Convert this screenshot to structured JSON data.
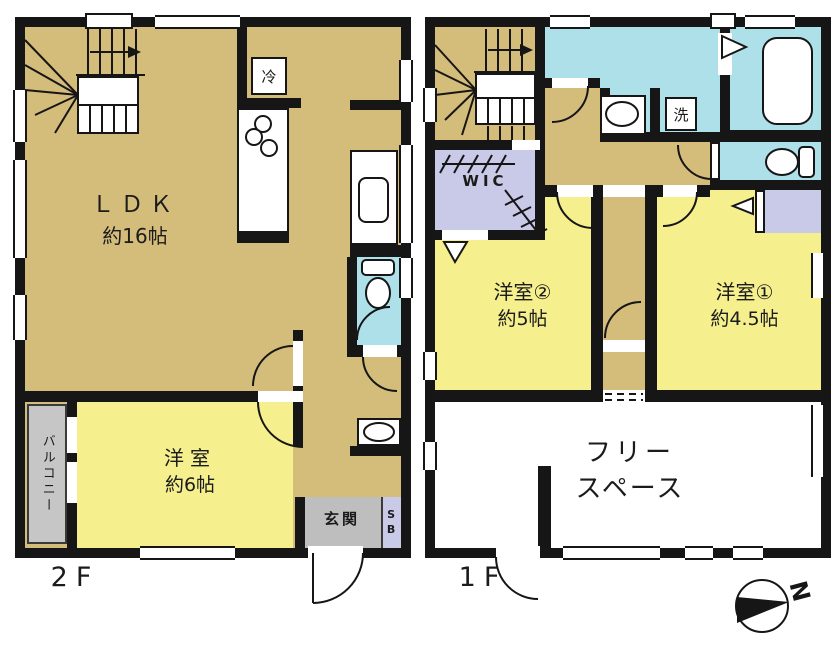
{
  "floors": {
    "f2": {
      "floor_label": "2F",
      "ldk_name": "ＬＤＫ",
      "ldk_size": "約16帖",
      "bedroom_name": "洋室",
      "bedroom_size": "約6帖",
      "balcony": "バルコニー",
      "entrance": "玄関",
      "shoebox": "SB",
      "fridge": "冷"
    },
    "f1": {
      "floor_label": "1F",
      "wic": "WIC",
      "bedroom2_name": "洋室②",
      "bedroom2_size": "約5帖",
      "bedroom1_name": "洋室①",
      "bedroom1_size": "約4.5帖",
      "freespace_line1": "フリー",
      "freespace_line2": "スペース",
      "laundry": "洗"
    }
  },
  "compass_n": "N",
  "colors": {
    "wall": "#161616",
    "floor_tan": "#d4bc7a",
    "room_yellow": "#f5ef8e",
    "wet_blue": "#aee0ea",
    "closet_lavender": "#c9c9e8",
    "balcony_gray": "#c6c6c6",
    "entrance_gray": "#bebebe",
    "free_space_white": "#ffffff"
  }
}
